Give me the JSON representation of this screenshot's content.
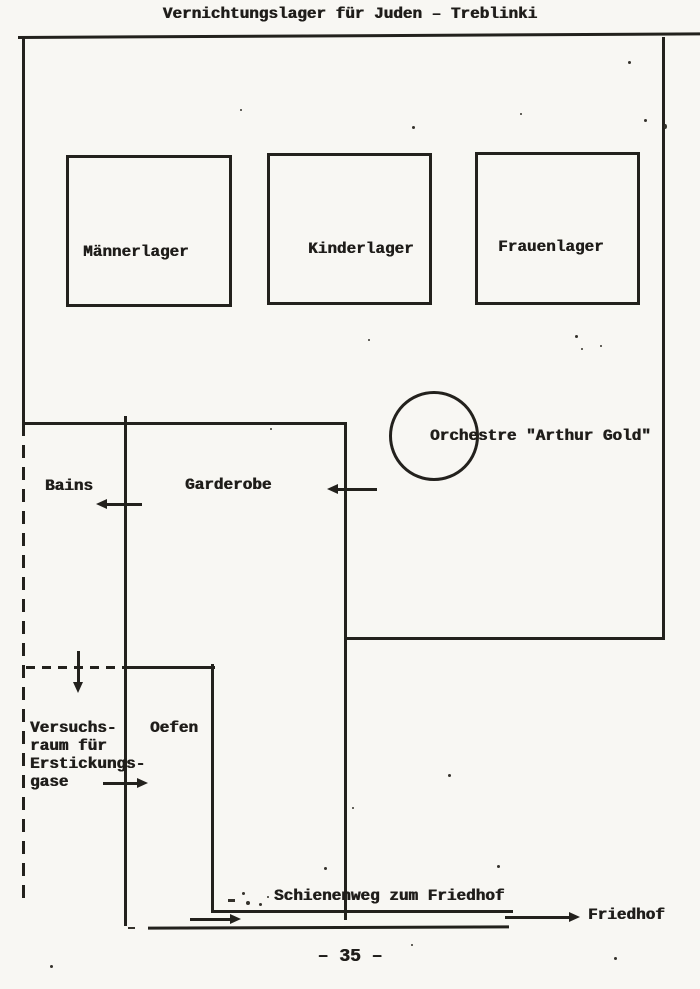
{
  "document": {
    "title": "Vernichtungslager für Juden – Treblinki",
    "page_number": "– 35 –",
    "ink_color": "#23211d",
    "paper_color": "#f8f7f3"
  },
  "camp": {
    "barracks": [
      {
        "id": "maennerlager",
        "label": "Männerlager"
      },
      {
        "id": "kinderlager",
        "label": "Kinderlager"
      },
      {
        "id": "frauenlager",
        "label": "Frauenlager"
      }
    ],
    "orchestra": {
      "label": "Orchestre \"Arthur Gold\""
    },
    "rooms": {
      "bains_label": "Bains",
      "garderobe_label": "Garderobe",
      "versuchsraum_label": "Versuchs-\nraum für\nErstickungs-\ngase",
      "oefen_label": "Oefen"
    },
    "rail": {
      "track_label": "Schienenweg zum Friedhof",
      "destination_label": "Friedhof"
    }
  }
}
